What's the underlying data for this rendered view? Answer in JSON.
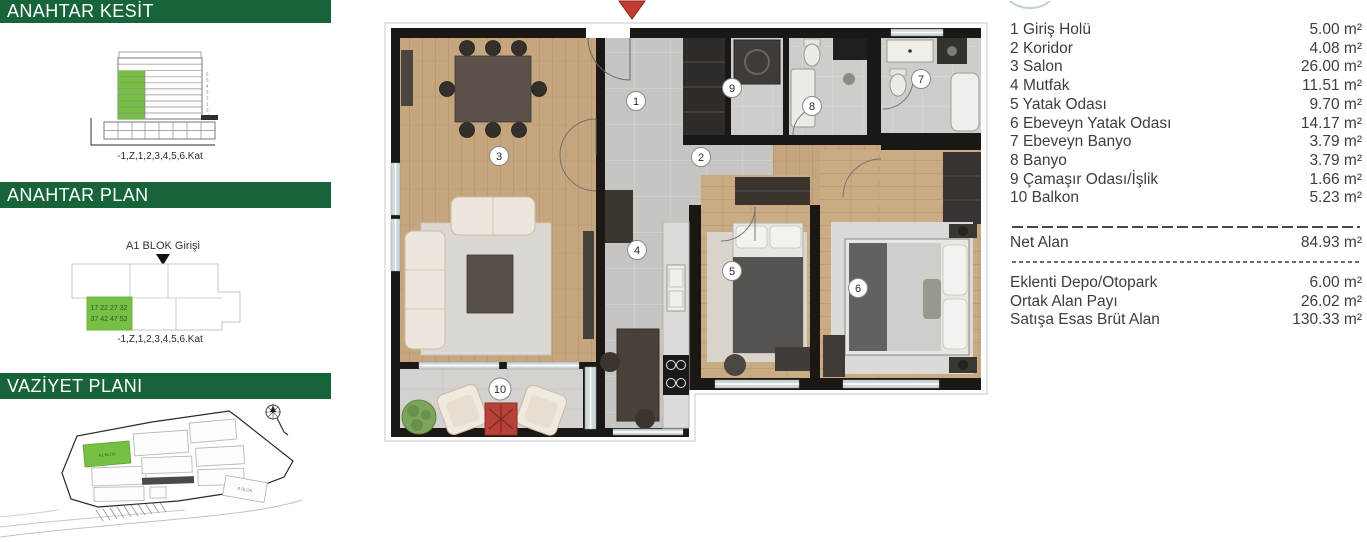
{
  "colors": {
    "header_green": "#17633A",
    "highlight_green": "#76C043",
    "entrance_arrow_red": "#C23B31"
  },
  "sidebar": {
    "kesit": {
      "title": "ANAHTAR KESİT",
      "caption": "-1,Z,1,2,3,4,5,6.Kat",
      "floor_labels": [
        "6",
        "5",
        "4",
        "3",
        "2",
        "1",
        "Z",
        "-1"
      ]
    },
    "plan": {
      "title": "ANAHTAR PLAN",
      "entrance_label": "A1 BLOK Girişi",
      "unit_rows": [
        "17 22 27 32",
        "37 42 47 52"
      ],
      "caption": "-1,Z,1,2,3,4,5,6.Kat"
    },
    "vaziyet": {
      "title": "VAZİYET PLANI",
      "highlight_block": "A1 BLOK",
      "other_block": "B BLOK"
    }
  },
  "floorplan": {
    "badges": [
      {
        "num": "1"
      },
      {
        "num": "2"
      },
      {
        "num": "3"
      },
      {
        "num": "4"
      },
      {
        "num": "5"
      },
      {
        "num": "6"
      },
      {
        "num": "7"
      },
      {
        "num": "8"
      },
      {
        "num": "9"
      },
      {
        "num": "10"
      }
    ]
  },
  "room_list": {
    "items": [
      {
        "no": "1",
        "name": "Giriş Holü",
        "area": "5.00 m²"
      },
      {
        "no": "2",
        "name": "Koridor",
        "area": "4.08 m²"
      },
      {
        "no": "3",
        "name": "Salon",
        "area": "26.00 m²"
      },
      {
        "no": "4",
        "name": "Mutfak",
        "area": "11.51 m²"
      },
      {
        "no": "5",
        "name": "Yatak Odası",
        "area": "9.70 m²"
      },
      {
        "no": "6",
        "name": "Ebeveyn Yatak Odası",
        "area": "14.17 m²"
      },
      {
        "no": "7",
        "name": "Ebeveyn Banyo",
        "area": "3.79 m²"
      },
      {
        "no": "8",
        "name": "Banyo",
        "area": "3.79 m²"
      },
      {
        "no": "9",
        "name": "Çamaşır Odası/İşlik",
        "area": "1.66 m²"
      },
      {
        "no": "10",
        "name": "Balkon",
        "area": "5.23 m²"
      }
    ],
    "net": {
      "label": "Net Alan",
      "value": "84.93 m²"
    },
    "extras": [
      {
        "label": "Eklenti Depo/Otopark",
        "value": "6.00 m²"
      },
      {
        "label": "Ortak Alan Payı",
        "value": "26.02 m²"
      },
      {
        "label": "Satışa Esas Brüt Alan",
        "value": "130.33 m²"
      }
    ]
  }
}
